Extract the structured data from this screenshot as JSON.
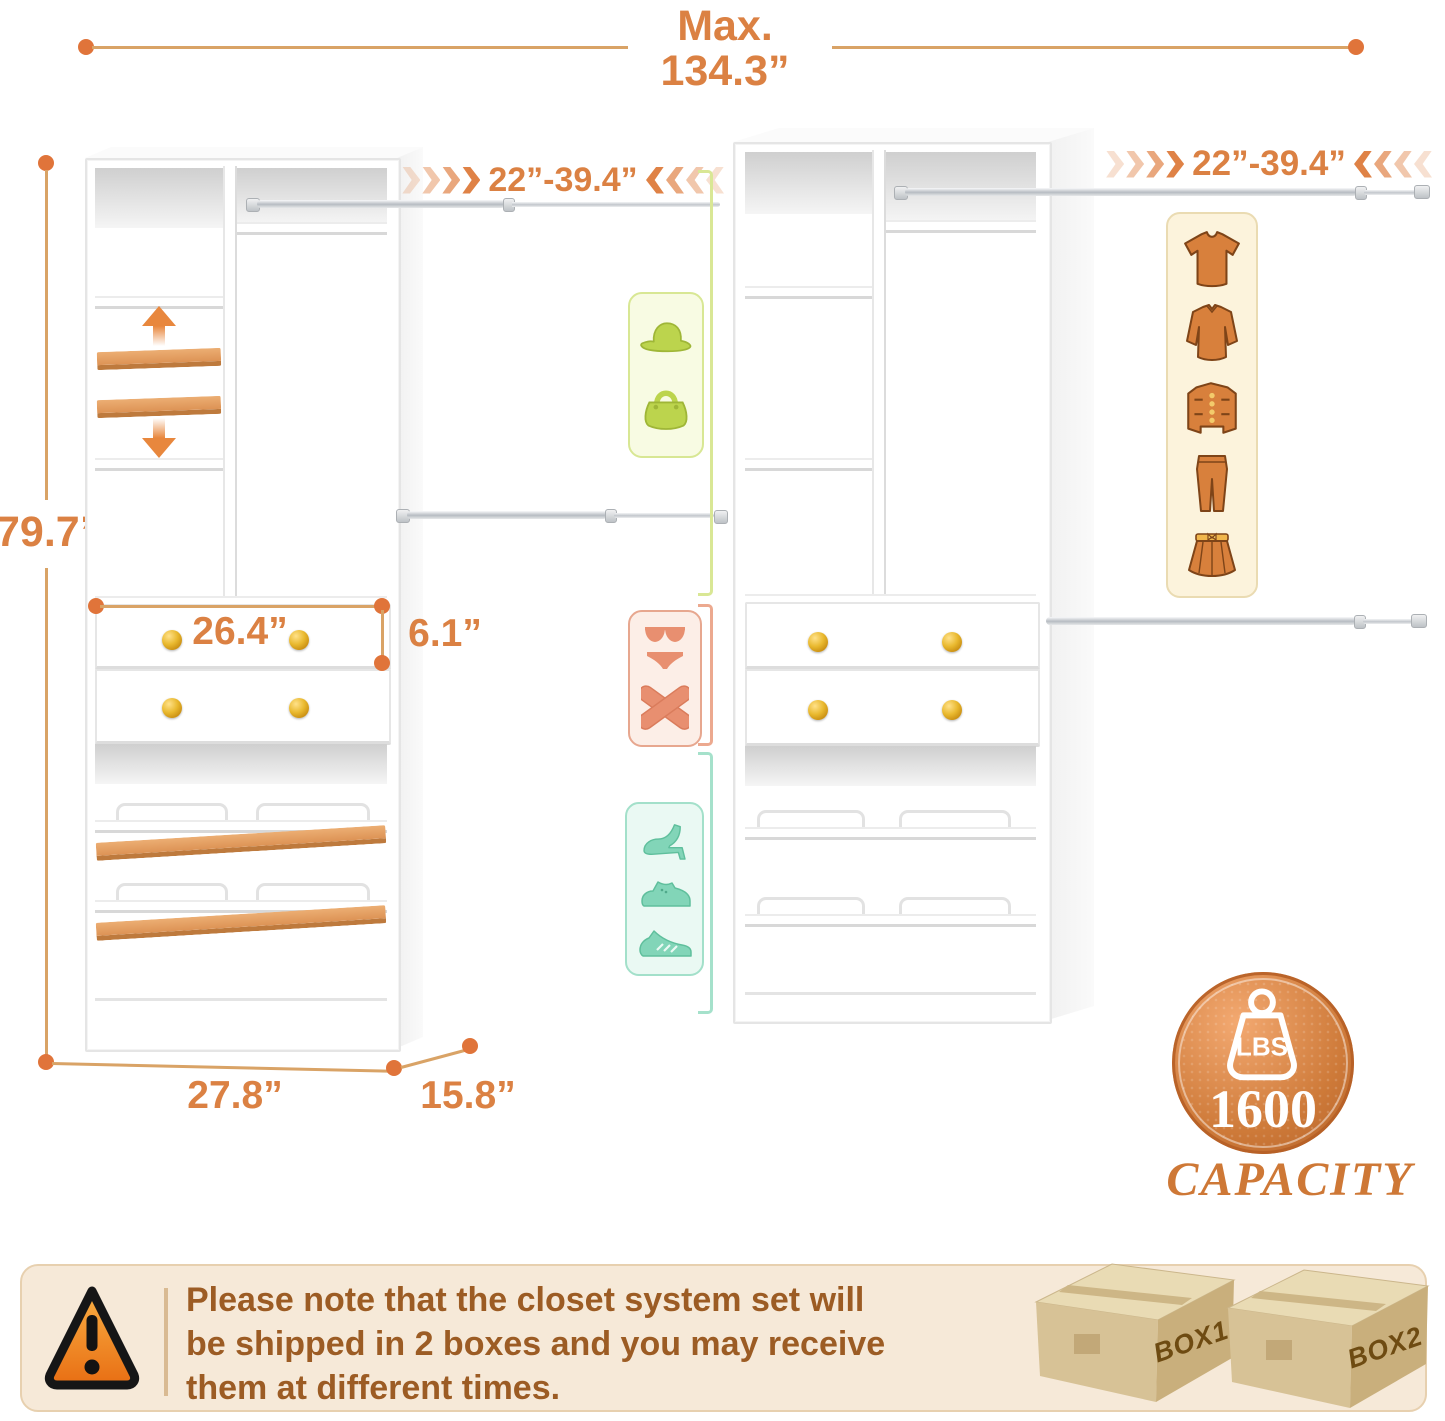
{
  "meta": {
    "type": "product-dimension-diagram",
    "subject": "2-piece closet organizer system"
  },
  "dims": {
    "max_label": "Max.",
    "max_value": "134.3”",
    "height": "79.7”",
    "rod_left": "22”-39.4”",
    "rod_right": "22”-39.4”",
    "drawer_width": "26.4”",
    "drawer_height": "6.1”",
    "unit_width": "27.8”",
    "unit_depth": "15.8”"
  },
  "badge": {
    "lbs": "LBS",
    "value": "1600",
    "caption": "CAPACITY"
  },
  "notice": {
    "line1": "Please note that the closet system set will",
    "line2": "be shipped in 2 boxes and you may receive",
    "line3": "them at different times."
  },
  "boxes": {
    "box1": "BOX1",
    "box2": "BOX2"
  },
  "icons": {
    "accessories_panel": [
      "sun-hat",
      "handbag"
    ],
    "underwear_panel": [
      "lingerie",
      "crossed-top"
    ],
    "shoes_panel": [
      "high-heel",
      "dress-shoe",
      "sneaker"
    ],
    "clothing_panel": [
      "t-shirt",
      "long-sleeve-shirt",
      "jacket",
      "pants",
      "skirt"
    ]
  },
  "colors": {
    "accent_orange": "#DB8143",
    "dim_line": "#D9A366",
    "dim_dot": "#E0743A",
    "gold_knob": "#E9B92F",
    "green": "#BCD44D",
    "salmon": "#E88F70",
    "teal": "#82D5B8",
    "clothing_orange": "#D8803C",
    "banner_text": "#9C5C24",
    "capacity_text": "#CE7836"
  }
}
